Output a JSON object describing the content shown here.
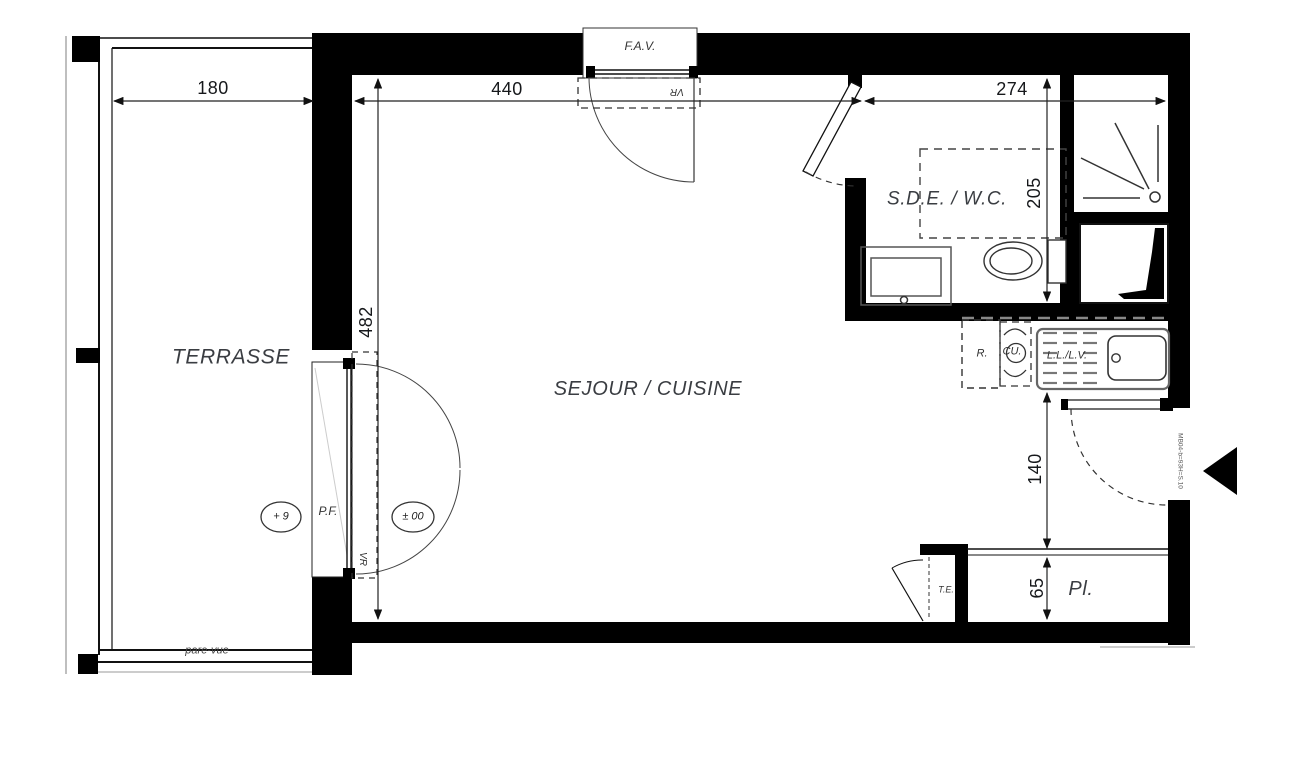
{
  "rooms": {
    "terrace": "TERRASSE",
    "living_kitchen": "SEJOUR / CUISINE",
    "shower_wc": "S.D.E. / W.C.",
    "closet": "Pl."
  },
  "dimensions_cm": {
    "terrace_width": "180",
    "living_width": "440",
    "right_wing_width": "274",
    "living_depth": "482",
    "shower_room_depth": "205",
    "entry_nook_depth": "140",
    "closet_depth": "65"
  },
  "annotations": {
    "upper_window": "F.A.V.",
    "roller_shutter_top": "VR",
    "roller_shutter_left": "VR",
    "french_window": "P.F.",
    "terrace_level": "+ 9",
    "floor_level": "± 00",
    "privacy_screen": "pare-vue",
    "electrical_panel": "T.E.",
    "fridge": "R.",
    "cooktop": "CU.",
    "washer_dishwasher": "L.L./L.V.",
    "entry_door_ref": "MB04-b=93H=S.10"
  }
}
